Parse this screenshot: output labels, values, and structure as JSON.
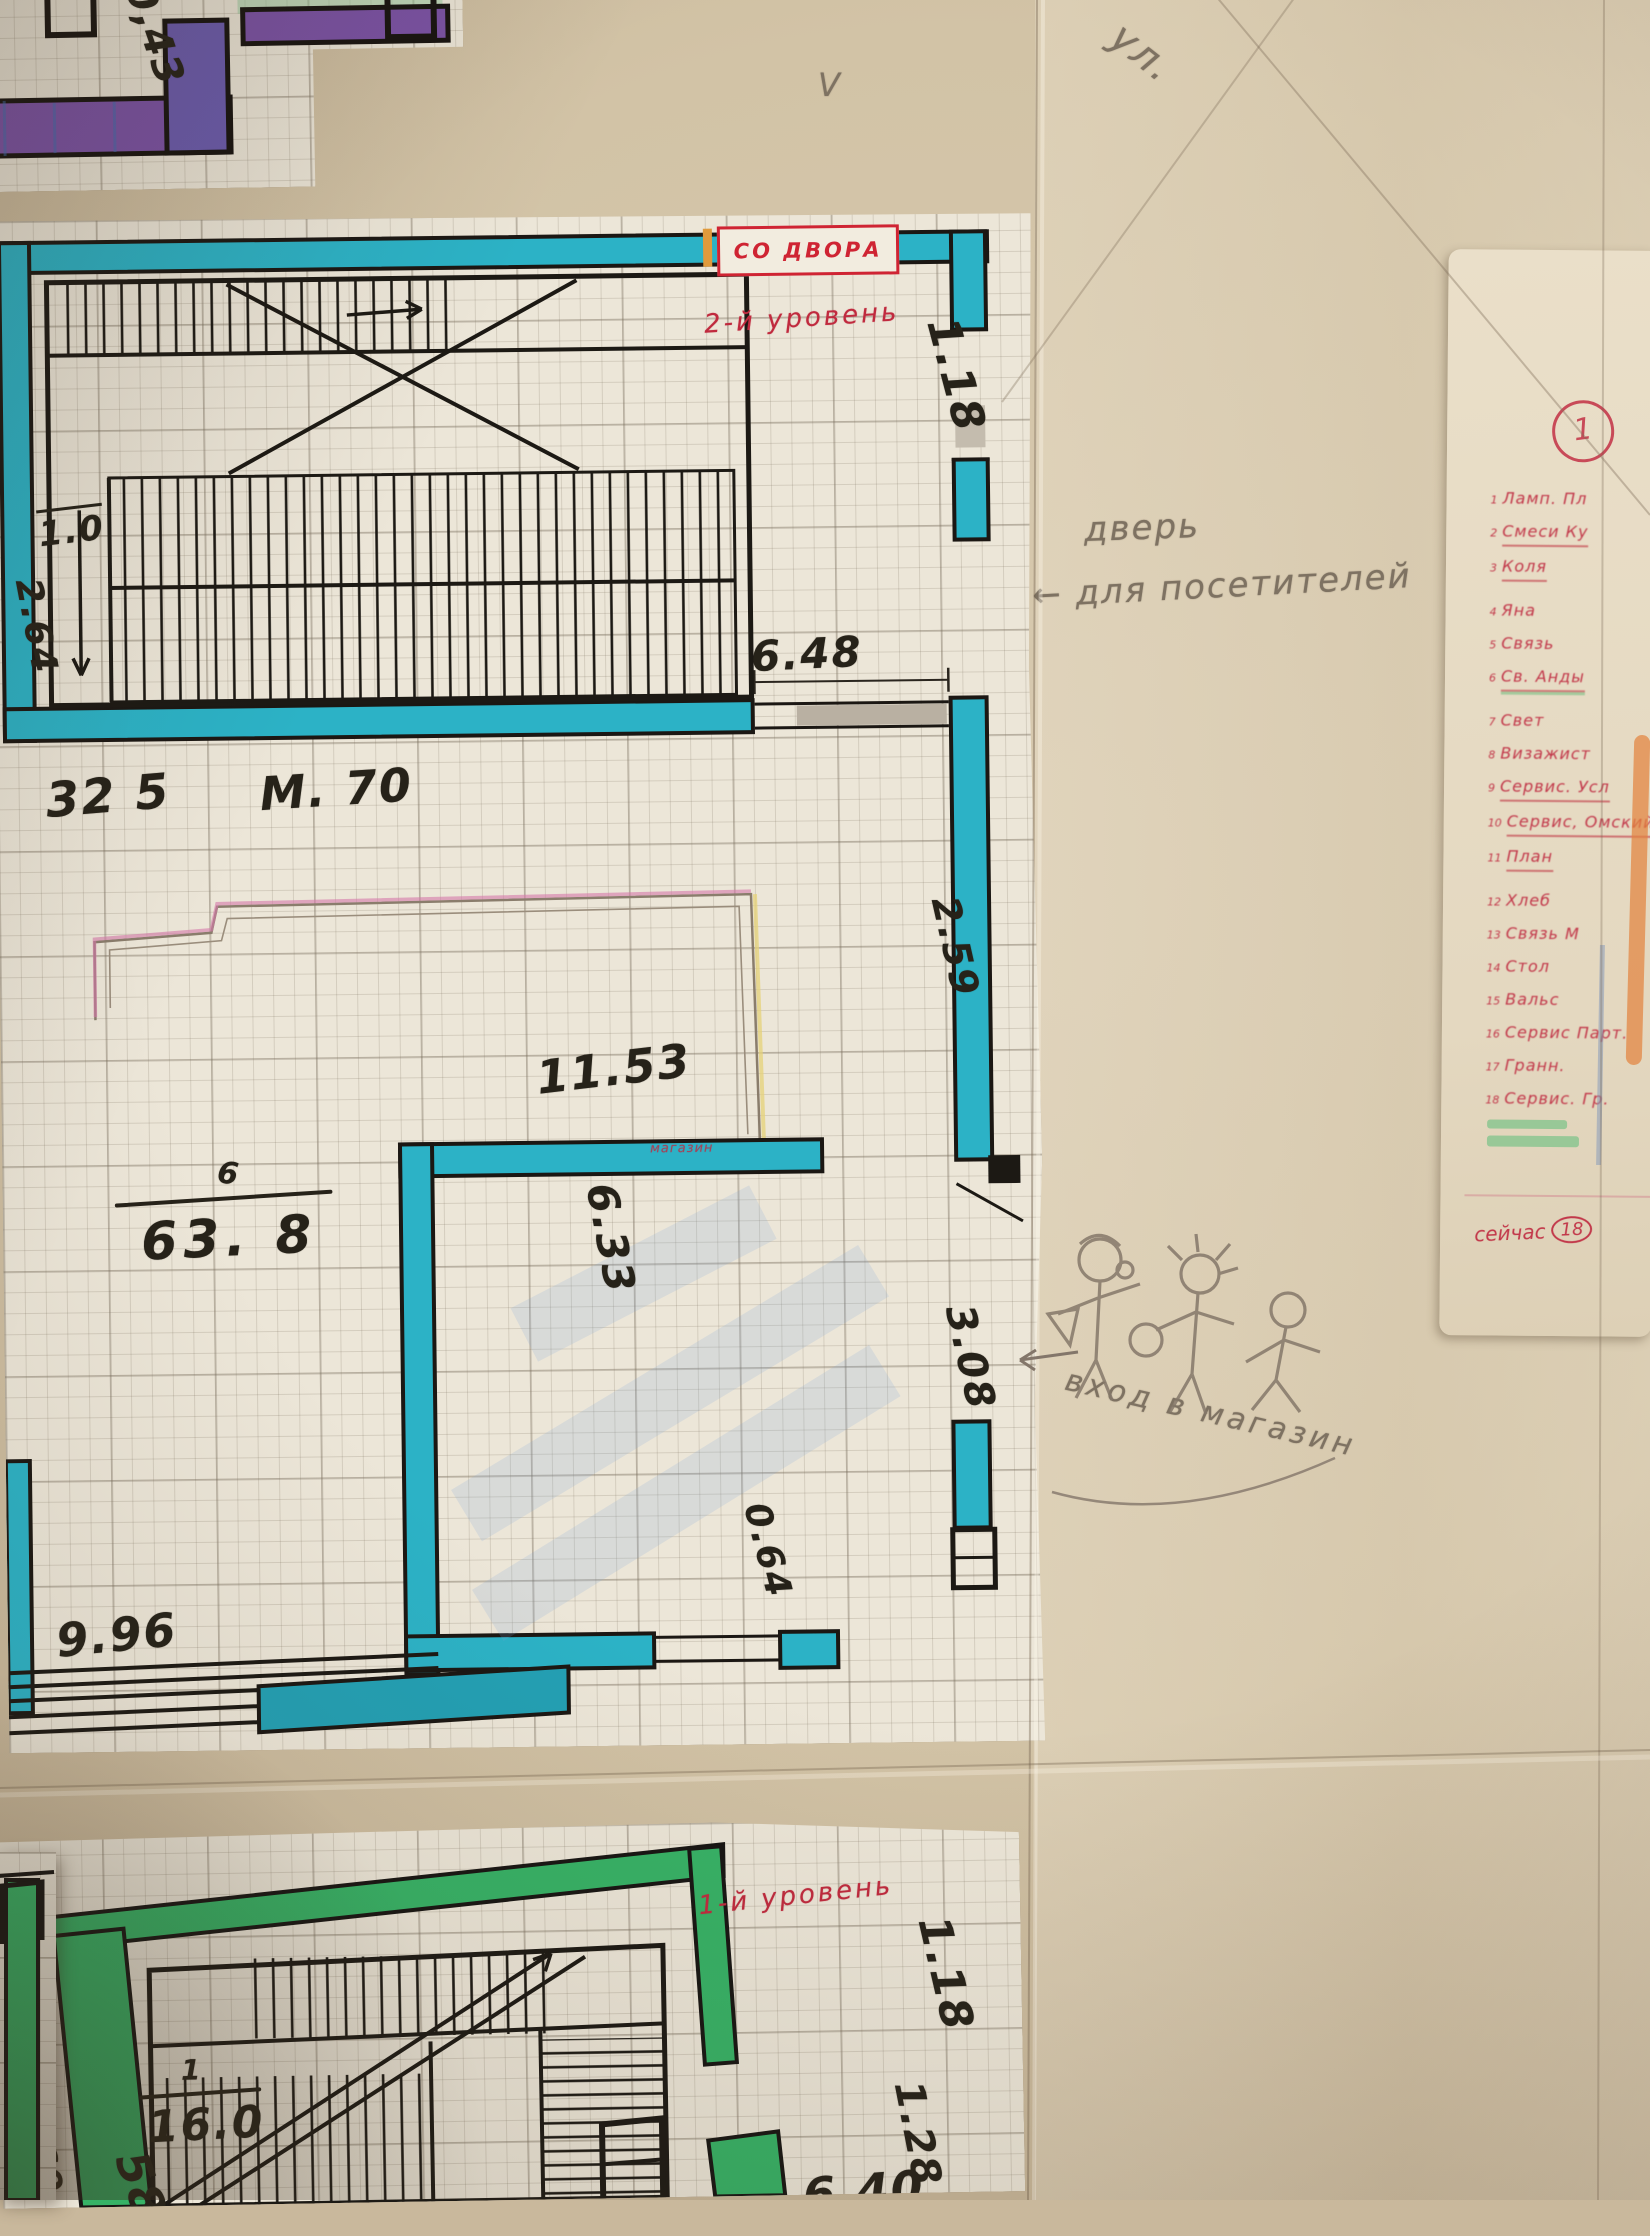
{
  "photo": {
    "street_note": "ул.",
    "check_mark": "V",
    "door_note_line1": "дверь",
    "door_note_line2": "← для посетителей",
    "shop_entrance_note": "вход в магазин"
  },
  "top_fragment": {
    "dim_043": "0,43"
  },
  "upper_plan": {
    "level_label": "2-й уровень",
    "yard_entrance_label": "СО ДВОРА",
    "shop_label": "магазин",
    "dims": {
      "w_118": "1.18",
      "w_648": "6.48",
      "w_10": "1.0",
      "w_264": "2.64",
      "area_325": "32 5",
      "h_m70": "М. 70",
      "w_259": "2.59",
      "w_1153": "11.53",
      "room_number": "6",
      "room_area": "63. 8",
      "w_633": "6.33",
      "w_308": "3.08",
      "w_064": "0.64",
      "w_996": "9.96"
    }
  },
  "lower_plan": {
    "level_label": "1-й уровень",
    "dims": {
      "w_118": "1.18",
      "room_number": "1",
      "room_area": "16.0",
      "w_269": "2.69",
      "w_58": "58",
      "w_128": "1.28",
      "w_640": "6.40"
    }
  },
  "note_card": {
    "page_badge": "1",
    "items": [
      {
        "n": "1",
        "text": "Ламп. Пл",
        "u": "",
        "gap": false
      },
      {
        "n": "2",
        "text": "Смеси Ку",
        "u": "red",
        "gap": false
      },
      {
        "n": "3",
        "text": "Коля",
        "u": "red",
        "gap": false
      },
      {
        "n": "4",
        "text": "Яна",
        "u": "",
        "gap": true
      },
      {
        "n": "5",
        "text": "Связь",
        "u": "",
        "gap": false
      },
      {
        "n": "6",
        "text": "Св. Анды",
        "u": "greenred",
        "gap": false
      },
      {
        "n": "7",
        "text": "Свет",
        "u": "",
        "gap": true
      },
      {
        "n": "8",
        "text": "Визажист",
        "u": "",
        "gap": false
      },
      {
        "n": "9",
        "text": "Сервис. Усл",
        "u": "red",
        "gap": false
      },
      {
        "n": "10",
        "text": "Сервис, Омский",
        "u": "red",
        "gap": false
      },
      {
        "n": "11",
        "text": "План",
        "u": "red",
        "gap": false
      },
      {
        "n": "12",
        "text": "Хлеб",
        "u": "",
        "gap": true
      },
      {
        "n": "13",
        "text": "Связь М",
        "u": "",
        "gap": false
      },
      {
        "n": "14",
        "text": "Стол",
        "u": "",
        "gap": false
      },
      {
        "n": "15",
        "text": "Вальс",
        "u": "",
        "gap": false
      },
      {
        "n": "16",
        "text": "Сервис Парт.",
        "u": "",
        "gap": false
      },
      {
        "n": "17",
        "text": "Гранн.",
        "u": "",
        "gap": false
      },
      {
        "n": "18",
        "text": "Сервис. Гр.",
        "u": "",
        "gap": false
      }
    ],
    "footer_label": "сейчас",
    "footer_count": "18"
  },
  "colors": {
    "wall_cyan": "#2cb2c6",
    "wall_purple": "#7b52a6",
    "wall_green": "#36b266",
    "red_ink": "#c02a3e",
    "pencil": "#7e7262",
    "paper": "#ece6d8",
    "background": "#cdbda1"
  }
}
